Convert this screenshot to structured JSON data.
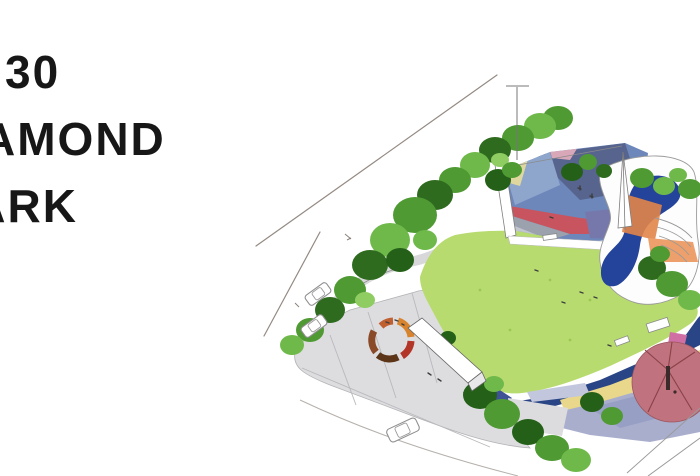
{
  "slide": {
    "title": {
      "lines": [
        "30",
        "DIAMOND",
        "PARK"
      ],
      "visible_fragments": [
        "30",
        "AMOND",
        "RK"
      ]
    }
  },
  "palette": {
    "background": "#ffffff",
    "title_text": "#171717",
    "lawn": "#b8db70",
    "navy_path": "#2a4585",
    "pool": "#24439a",
    "yellow_path": "#e9d78c",
    "lavender": "#a9aecd",
    "lavender_dark": "#8d95c0",
    "path_lavender": "#c3c7dd",
    "pavilion_pink": "#c0737e",
    "pavilion_seam": "#8a4148",
    "pavement": "#dddde0",
    "pink_accent": "#cf6fa4",
    "plaza": {
      "steel": "#6d87ba",
      "slate": "#56648e",
      "steel_light": "#8fa6cc",
      "red": "#c8545f",
      "gray": "#9ba1ad",
      "light_gray": "#c2c5cd",
      "purple": "#7678ac",
      "navy": "#2d3f77",
      "orange": "#e28549",
      "orange_light": "#eda06b",
      "yellow": "#ded7a0",
      "pink": "#d8a8b8",
      "light_blue": "#aac4de"
    },
    "ring": {
      "brown": "#8a4a28",
      "dark": "#5c3418",
      "red": "#b33527",
      "orange": "#d8842e"
    }
  }
}
